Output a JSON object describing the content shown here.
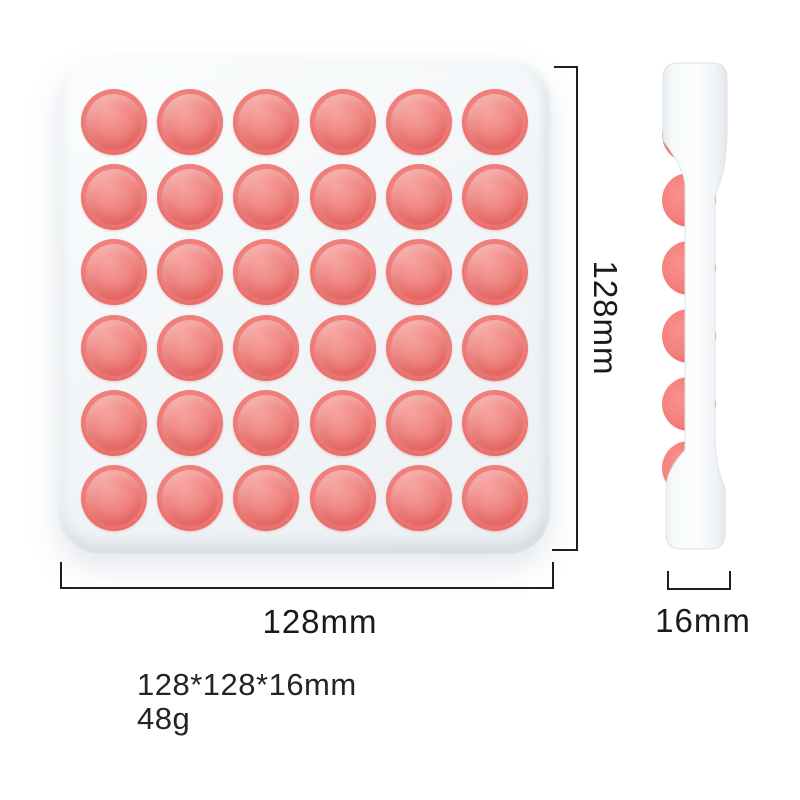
{
  "product": {
    "name": "pop-it-fidget-toy",
    "front_view": {
      "rows": 6,
      "cols": 6
    },
    "dimensions": {
      "height_label": "128mm",
      "width_label": "128mm",
      "thickness_label": "16mm"
    },
    "specs": {
      "size": "128*128*16mm",
      "weight": "48g"
    },
    "colors": {
      "bubble_ring": "#e25c58",
      "bubble_dome": "#f08783",
      "bubble_highlight": "#f7a4a0",
      "tray": "#f3f6f8",
      "tray_shadow": "#aeb9c3",
      "dimension_line": "#1e1e1e"
    }
  }
}
